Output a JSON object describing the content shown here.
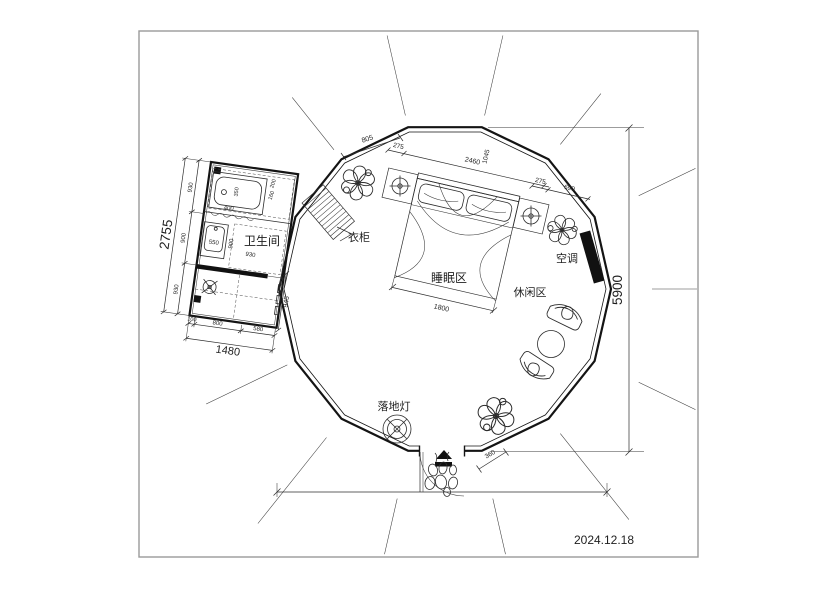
{
  "title_block": {
    "date": "2024.12.18"
  },
  "rooms": {
    "bathroom": "卫生间",
    "sleeping_area": "睡眠区",
    "leisure_area": "休闲区"
  },
  "furniture": {
    "wardrobe": "衣柜",
    "air_conditioner": "空调",
    "floor_lamp": "落地灯"
  },
  "dimensions": {
    "overall_height": "5900",
    "bed_width": "1800",
    "door_offset": "360",
    "top_chain": [
      "805",
      "275",
      "2460",
      "1045"
    ],
    "right_chain": [
      "275",
      "690"
    ],
    "bathroom": {
      "total_width": "1480",
      "total_height": "2755",
      "left_segments": [
        "930",
        "900",
        "930"
      ],
      "bottom_segments": [
        "100",
        "800",
        "580"
      ],
      "right_depth": "945",
      "basin": "550",
      "inner_width": "900",
      "inner_width2": "930",
      "tub_length": "400",
      "tub_width": "350",
      "shelf_dims": [
        "200",
        "160"
      ]
    }
  },
  "colors": {
    "line": "#2c2c2c",
    "accent_fill": "#111111",
    "frame": "#9a9a9a"
  }
}
